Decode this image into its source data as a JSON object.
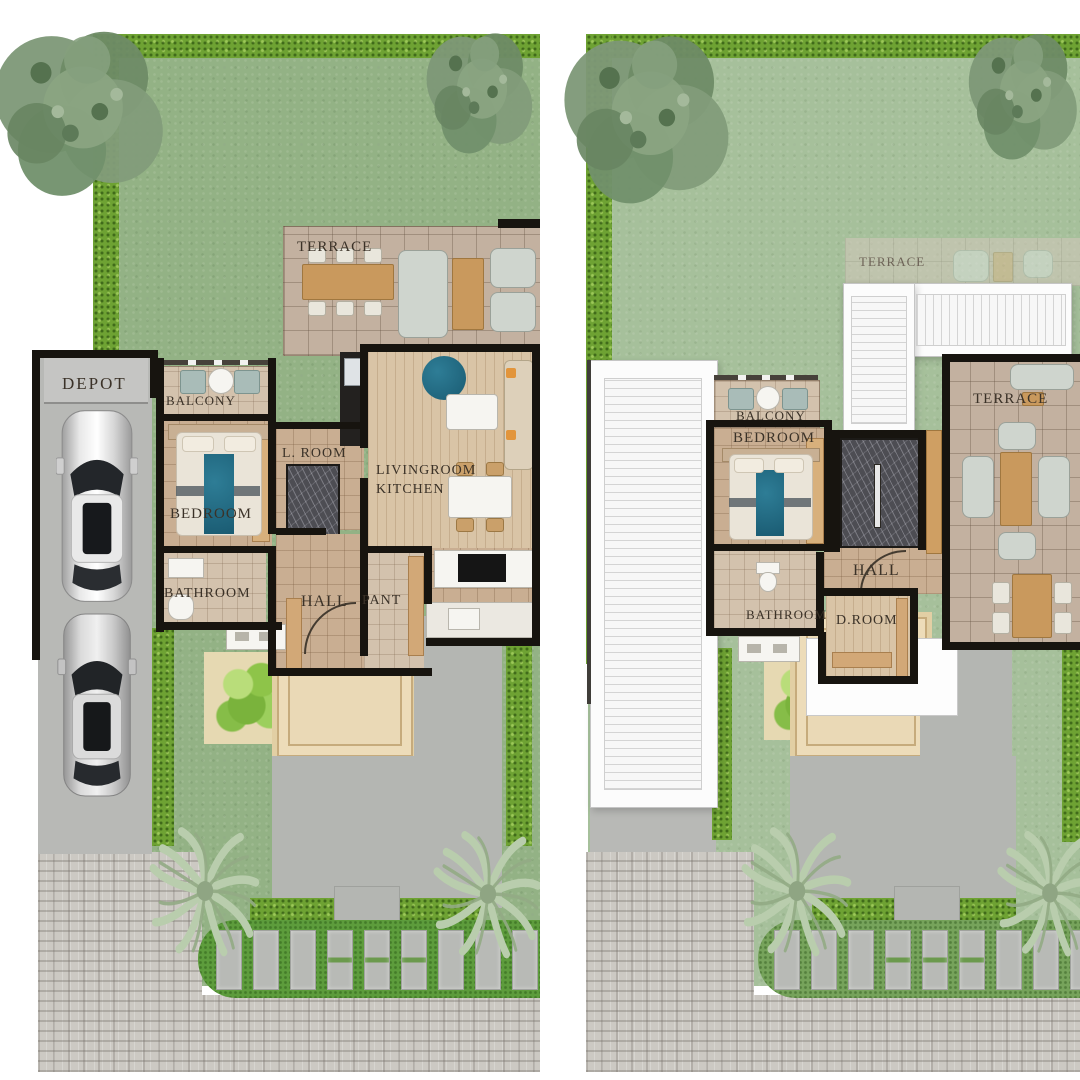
{
  "colors": {
    "background": "#ffffff",
    "grass_left": "#93b285",
    "grass_right": "#a6c09b",
    "hedge": "#6ea233",
    "wall": "#17140f",
    "terrace_tile": "#c3b1a0",
    "room_floor": "#c9ae92",
    "wood_floor": "#d9c4a6",
    "driveway": "#b8b9b6",
    "cobblestone": "#ccc9c3",
    "deck": "#ead9b6",
    "roof_white": "#fcfcfc",
    "stair_marble": "#4d4d53",
    "bed_teal": "#1e6b80",
    "label_text": "#3b3228"
  },
  "left_plan": {
    "labels": {
      "terrace": "TERRACE",
      "depot": "DEPOT",
      "balcony": "BALCONY",
      "bedroom": "BEDROOM",
      "l_room": "L. ROOM",
      "livingroom": "LIVINGROOM",
      "kitchen": "KITCHEN",
      "bathroom": "BATHROOM",
      "hall": "HALL",
      "pant": "PANT"
    }
  },
  "right_plan": {
    "labels": {
      "terrace_rear": "TERRACE",
      "balcony": "BALCONY",
      "bedroom": "BEDROOM",
      "terrace_front": "TERRACE",
      "hall": "HALL",
      "bathroom": "BATHROOM",
      "d_room": "D.ROOM"
    }
  }
}
